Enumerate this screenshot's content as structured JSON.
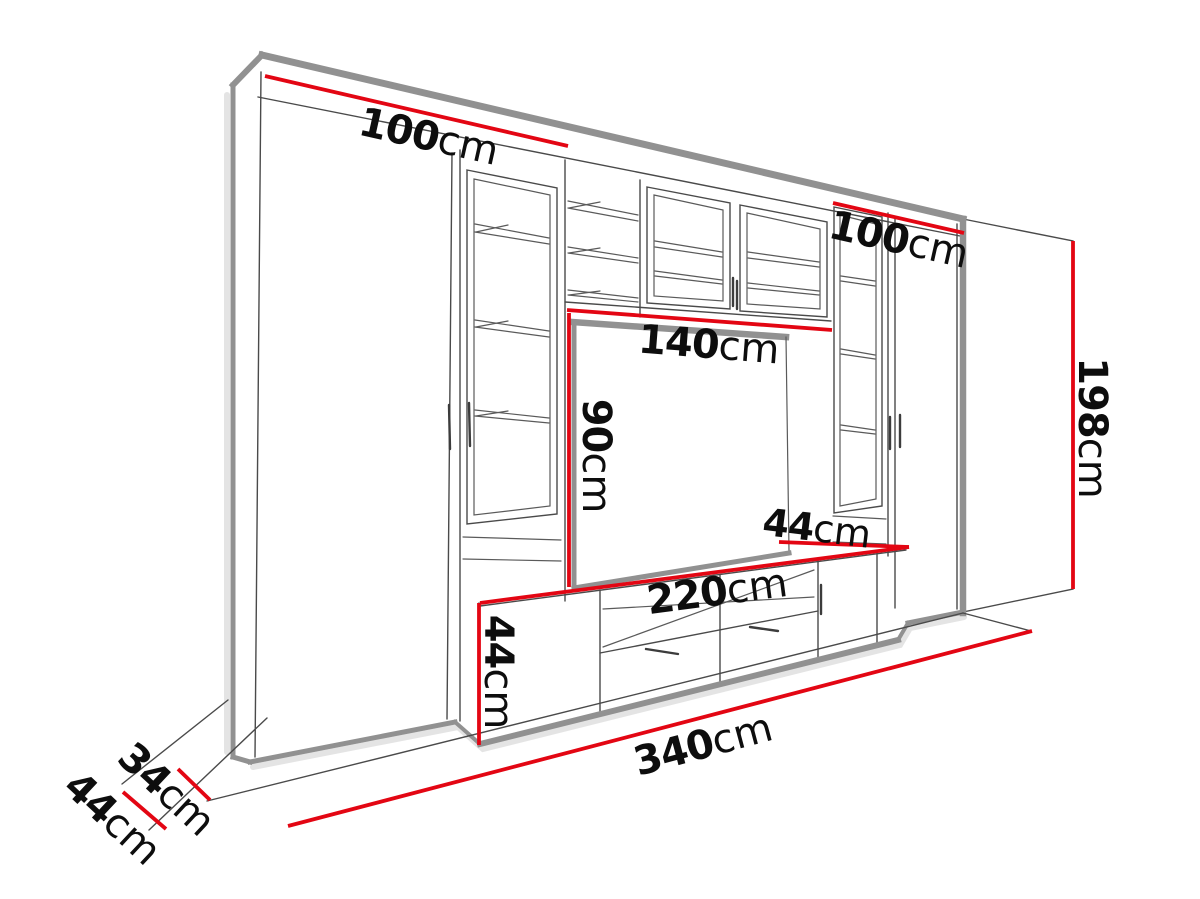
{
  "drawing": {
    "type": "furniture-dimension-diagram",
    "subject": "TV wall unit entertainment center, perspective line drawing with red dimension lines",
    "colors": {
      "dimension_line": "#e30613",
      "edge_gray": "#919191",
      "outline": "#4a4a4a",
      "text": "#0d0d0d",
      "background": "#ffffff"
    },
    "dimensions": {
      "left_section_width": {
        "value": "100",
        "unit": "cm"
      },
      "right_section_width": {
        "value": "100",
        "unit": "cm"
      },
      "niche_width": {
        "value": "140",
        "unit": "cm"
      },
      "niche_height": {
        "value": "90",
        "unit": "cm"
      },
      "niche_depth": {
        "value": "44",
        "unit": "cm"
      },
      "tv_stand_width": {
        "value": "220",
        "unit": "cm"
      },
      "tv_stand_height": {
        "value": "44",
        "unit": "cm"
      },
      "total_height": {
        "value": "198",
        "unit": "cm"
      },
      "total_width": {
        "value": "340",
        "unit": "cm"
      },
      "upper_depth": {
        "value": "34",
        "unit": "cm"
      },
      "base_depth": {
        "value": "44",
        "unit": "cm"
      }
    }
  }
}
